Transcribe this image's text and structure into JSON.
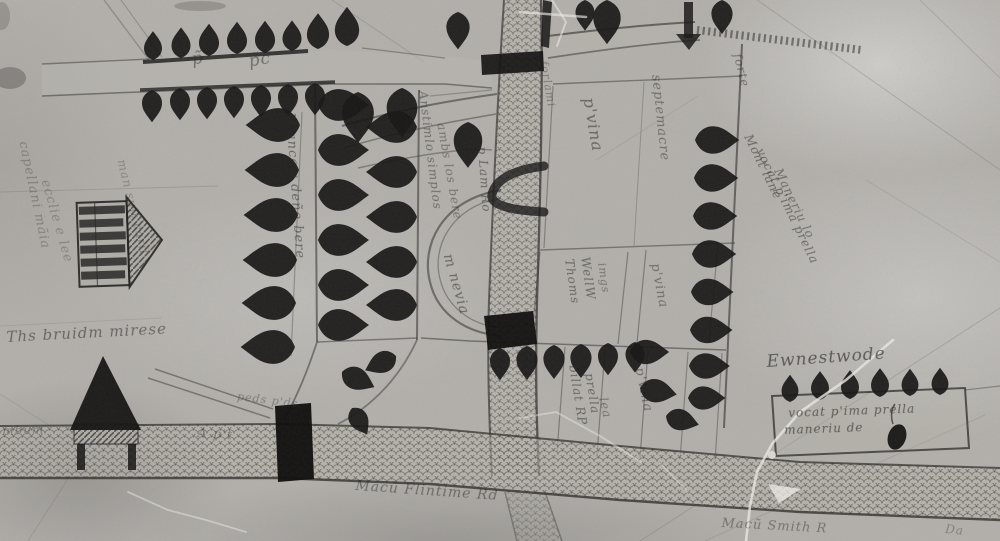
{
  "artifact": {
    "kind": "medieval-manuscript-estate-map-photograph",
    "monochrome": true
  },
  "palette": {
    "parchment": "#b4b1ac",
    "ink": "#181716",
    "ink_faint": "#4a4845",
    "crack_white": "#eceae6"
  },
  "labels": [
    {
      "id": "script-left-faint-1",
      "text": "capellani mãia",
      "x": 30,
      "y": 140,
      "rot": 78,
      "size": 13,
      "opacity": 0.32
    },
    {
      "id": "script-left-faint-2",
      "text": "ecclie e lee",
      "x": 52,
      "y": 178,
      "rot": 74,
      "size": 13,
      "opacity": 0.3
    },
    {
      "id": "script-left-faint-3",
      "text": "man suit caril",
      "x": 128,
      "y": 158,
      "rot": 76,
      "size": 12,
      "opacity": 0.3
    },
    {
      "id": "road-glyph-1",
      "text": "p̃",
      "x": 190,
      "y": 50,
      "rot": -10,
      "size": 17,
      "opacity": 0.5
    },
    {
      "id": "road-glyph-2",
      "text": "p̃c",
      "x": 247,
      "y": 52,
      "rot": -10,
      "size": 17,
      "opacity": 0.5
    },
    {
      "id": "avenue-lane-label",
      "text": "M ancew deñe bere",
      "x": 297,
      "y": 112,
      "rot": 86,
      "size": 13,
      "opacity": 0.55
    },
    {
      "id": "field-script-a",
      "text": "Anstimlo simplos",
      "x": 430,
      "y": 90,
      "rot": 83,
      "size": 12,
      "opacity": 0.5
    },
    {
      "id": "field-script-b",
      "text": "ambs los bere",
      "x": 448,
      "y": 122,
      "rot": 80,
      "size": 12,
      "opacity": 0.45
    },
    {
      "id": "via-label",
      "text": "m nevia",
      "x": 455,
      "y": 252,
      "rot": 74,
      "size": 14,
      "opacity": 0.55
    },
    {
      "id": "road-script",
      "text": "p Lam Ro",
      "x": 489,
      "y": 146,
      "rot": 86,
      "size": 12,
      "opacity": 0.55
    },
    {
      "id": "field-ferlami",
      "text": "forlami",
      "x": 550,
      "y": 60,
      "rot": 80,
      "size": 11,
      "opacity": 0.4
    },
    {
      "id": "field-prima-1",
      "text": "p'vina",
      "x": 598,
      "y": 96,
      "rot": 80,
      "size": 16,
      "opacity": 0.55
    },
    {
      "id": "field-septemacre",
      "text": "septemacre",
      "x": 663,
      "y": 74,
      "rot": 84,
      "size": 13,
      "opacity": 0.5
    },
    {
      "id": "forte-label",
      "text": "forte",
      "x": 744,
      "y": 52,
      "rot": 76,
      "size": 12,
      "opacity": 0.5
    },
    {
      "id": "montlane-1",
      "text": "Mont lane",
      "x": 754,
      "y": 132,
      "rot": 64,
      "size": 12,
      "opacity": 0.55
    },
    {
      "id": "montlane-2",
      "text": "vocat p'ima prella",
      "x": 766,
      "y": 146,
      "rot": 64,
      "size": 12,
      "opacity": 0.55
    },
    {
      "id": "montlane-3",
      "text": "Maneriu lo",
      "x": 784,
      "y": 166,
      "rot": 64,
      "size": 12,
      "opacity": 0.5
    },
    {
      "id": "strip-thomas-1",
      "text": "Thoms",
      "x": 576,
      "y": 258,
      "rot": 82,
      "size": 12,
      "opacity": 0.55
    },
    {
      "id": "strip-thomas-2",
      "text": "WellW",
      "x": 592,
      "y": 256,
      "rot": 82,
      "size": 12,
      "opacity": 0.55
    },
    {
      "id": "strip-thomas-3",
      "text": "imgs",
      "x": 608,
      "y": 262,
      "rot": 82,
      "size": 11,
      "opacity": 0.45
    },
    {
      "id": "strip-prima-2",
      "text": "p'vina",
      "x": 662,
      "y": 262,
      "rot": 79,
      "size": 13,
      "opacity": 0.5
    },
    {
      "id": "strip-billat-1",
      "text": "billat RP",
      "x": 580,
      "y": 364,
      "rot": 81,
      "size": 12,
      "opacity": 0.55
    },
    {
      "id": "strip-billat-2",
      "text": "prella",
      "x": 596,
      "y": 372,
      "rot": 81,
      "size": 12,
      "opacity": 0.55
    },
    {
      "id": "strip-billat-3",
      "text": "lea",
      "x": 610,
      "y": 396,
      "rot": 78,
      "size": 12,
      "opacity": 0.45
    },
    {
      "id": "strip-prima-3",
      "text": "p'vina",
      "x": 646,
      "y": 366,
      "rot": 78,
      "size": 13,
      "opacity": 0.5
    },
    {
      "id": "ewnestwode-label",
      "text": "Ewnestwode",
      "x": 766,
      "y": 352,
      "rot": -4,
      "size": 17,
      "opacity": 0.65
    },
    {
      "id": "box-line-1",
      "text": "vocat p'ima prella",
      "x": 788,
      "y": 406,
      "rot": -2,
      "size": 12,
      "opacity": 0.65
    },
    {
      "id": "box-line-2",
      "text": "maneriu de",
      "x": 784,
      "y": 423,
      "rot": -2,
      "size": 12,
      "opacity": 0.65
    },
    {
      "id": "road-label-south-1",
      "text": "Macũ Flintime Rd",
      "x": 356,
      "y": 478,
      "rot": 4,
      "size": 14,
      "opacity": 0.5
    },
    {
      "id": "road-label-south-2",
      "text": "Macũ Smith R",
      "x": 722,
      "y": 516,
      "rot": 3,
      "size": 13,
      "opacity": 0.45
    },
    {
      "id": "road-label-south-3",
      "text": "Da",
      "x": 946,
      "y": 522,
      "rot": 6,
      "size": 12,
      "opacity": 0.35
    },
    {
      "id": "road-label-west",
      "text": "mbum",
      "x": 2,
      "y": 424,
      "rot": -2,
      "size": 12,
      "opacity": 0.38
    },
    {
      "id": "road-label-west-2",
      "text": "A p't",
      "x": 198,
      "y": 426,
      "rot": 4,
      "size": 13,
      "opacity": 0.4
    },
    {
      "id": "caption-left",
      "text": "Ths bruidm mirese",
      "x": 6,
      "y": 328,
      "rot": -3,
      "size": 15,
      "opacity": 0.55
    },
    {
      "id": "pedes-label",
      "text": "peds   p'ds",
      "x": 238,
      "y": 390,
      "rot": 7,
      "size": 11,
      "opacity": 0.38
    }
  ]
}
